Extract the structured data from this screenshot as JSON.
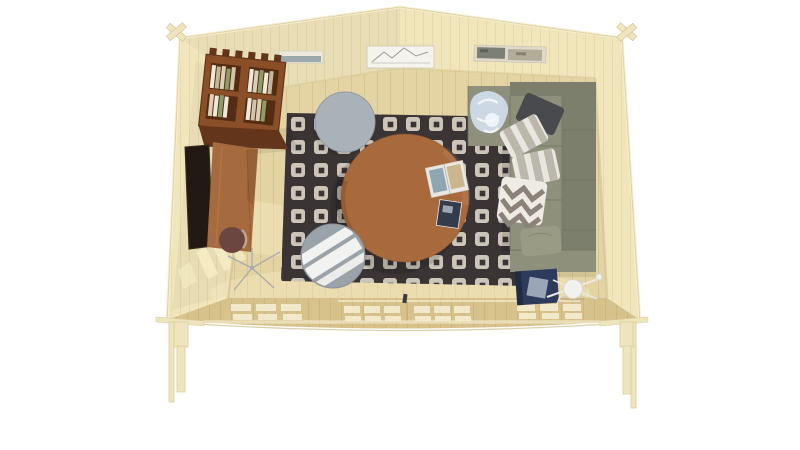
{
  "scene": {
    "type": "3d-render",
    "view": "top-down bird's-eye cutaway",
    "subject": "log cabin summerhouse interior with gable roof and raised corner legs",
    "background": "#ffffff"
  },
  "colors": {
    "background": "#ffffff",
    "wall": "#f0e5bb",
    "wallLine": "#dbcb96",
    "edgeLight": "#f7efd2",
    "edgeTan": "#d8c99a",
    "floor": "#e4d4a4",
    "floorLine": "#c9b67e",
    "frontWall": "#d8c28c",
    "frontLine": "#c2a970",
    "pane": "#f2e8ca",
    "sun": "#f8eec6",
    "rug": "#3a3435",
    "rugMotif": "#d8d2c4",
    "coffeeTable": "#a8693c",
    "desk": "#a56a3e",
    "deskDark": "#7e4e28",
    "stool": "#6b4540",
    "stoolRim": "#c4ada2",
    "shelf": "#8b4f28",
    "shelfDark": "#63351a",
    "shelfCavity": "#542c13",
    "bk1": "#eee9da",
    "bk2": "#d9d0b6",
    "bk3": "#c3b896",
    "bk4": "#8e9c66",
    "bk5": "#cfc5a9",
    "tv": "#221a12",
    "grayTable": "#a9b2b8",
    "pouf": "#9aa3a9",
    "poufLight": "#fafaf7",
    "sofa": "#8e907c",
    "sofaDark": "#7d7f6d",
    "sofaSeam": "#6d6f5e",
    "pillowWhite": "#e9e6df",
    "pillowStripe": "#b3aea4",
    "pillowDark": "#484a4e",
    "pillowOlive": "#999b85",
    "chevronBg": "#eeebe4",
    "chevron": "#8b8279",
    "blanket": "#ccd8e3",
    "blanketFold": "#f5f7f9",
    "navyTable": "#2c3a5b",
    "navyTop": "#9ba5b8",
    "lamp": "#f1f1ee",
    "lampArm": "#e9e8e0",
    "wire": "#a6abaf",
    "legWood": "#efe5bd",
    "artFrame": "#ece9dd",
    "art1": "#93a1a4",
    "art2Line": "#8c8c82",
    "art3a": "#7c8074",
    "art3b": "#b3ac99"
  },
  "objects": {
    "structure": "pale timber log cabin, gable roof apex at top, raised on notched corner legs",
    "bookshelf": "wall-mounted dark wood bookshelf with books, left wall",
    "tv": "flat-screen TV on left wall",
    "desk": "wooden desk along left wall",
    "stool": "round dark stool tucked under desk",
    "wire_stand": "thin metal stand on floor near desk",
    "rug": "dark charcoal rug with cream square motifs",
    "coffee_table": "round wooden coffee table",
    "magazines": "open magazine and small closed magazine on table",
    "side_table": "round gray side table at rug top edge",
    "pouf": "round gray pouf catching window light",
    "sofa": "L-shaped sage-green corner sofa along right wall",
    "blanket": "crumpled light-blue throw on chaise end",
    "pillows": "charcoal pillow, two white striped pillows, chevron pillow, olive pillow",
    "navy_table": "navy cube side table with pale tray on top",
    "floor_lamp": "white globe floor lamp with thin arms",
    "wall_art": [
      "small landscape print",
      "mountain sketch in white frame",
      "panoramic landscape prints"
    ],
    "front_glazing": "two glazed windows and glazed double doors in front wall",
    "door_handle": "dark handle between door panels"
  }
}
